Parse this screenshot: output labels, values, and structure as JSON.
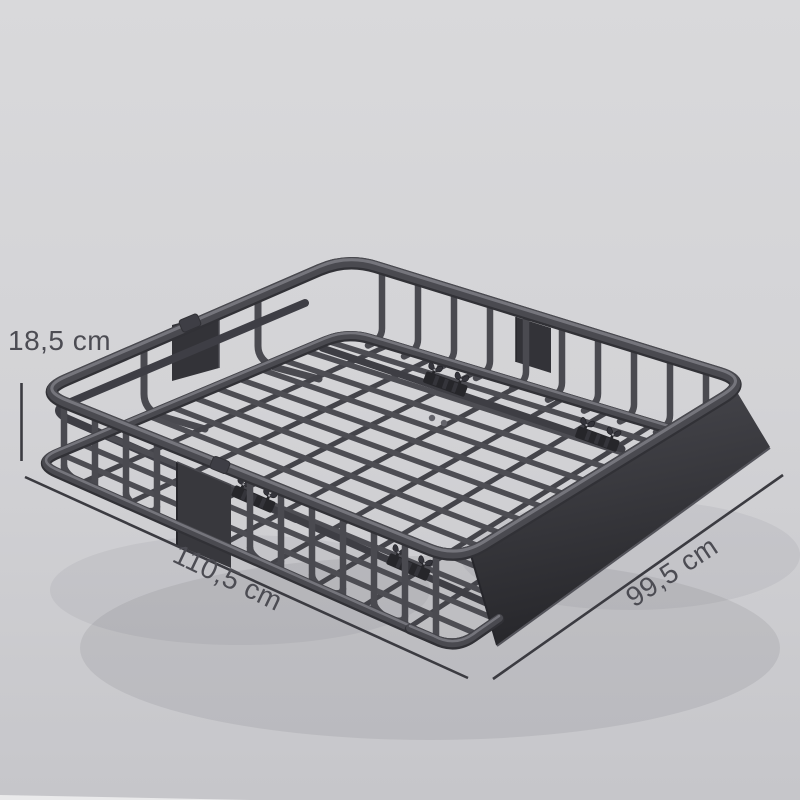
{
  "scene": {
    "object_name": "roof-cargo-basket",
    "view": "isometric product render with dimension annotations"
  },
  "dimensions": {
    "height": "18,5 cm",
    "length": "110,5 cm",
    "width": "99,5 cm"
  },
  "colors": {
    "background_top": "#d9d9db",
    "background_mid": "#d3d3d6",
    "background_bottom": "#c6c6ca",
    "background_corner_light": "#f2f2f3",
    "steel": "#4a4a50",
    "steel_dark": "#3e3e45",
    "steel_edge": "#313136",
    "steel_highlight": "#7d7d84",
    "floor_bar": "#4d4d53",
    "floor_bar_cross": "#44444a",
    "rail": "#3e3e44",
    "rail_cap": "#63636a",
    "panel": "#38383d",
    "panel_dark": "#333338",
    "panel_edge_dark": "#26262b",
    "panel_edge_light": "#4a4a50",
    "clamp": "#26262a",
    "clamp_notch": "#35353b",
    "wingnut": "#34343b",
    "screw": "#a6a6ac",
    "fairing_top": "#4a4a50",
    "fairing_mid": "#3a3a3f",
    "fairing_bottom": "#26262a",
    "fairing_edge_dark": "#1e1e22",
    "fairing_edge_light": "#54545b",
    "shadow": "rgba(70,70,80,0.10)",
    "annotation_text": "#4c4c53",
    "annotation_line": "#3b3b41"
  }
}
